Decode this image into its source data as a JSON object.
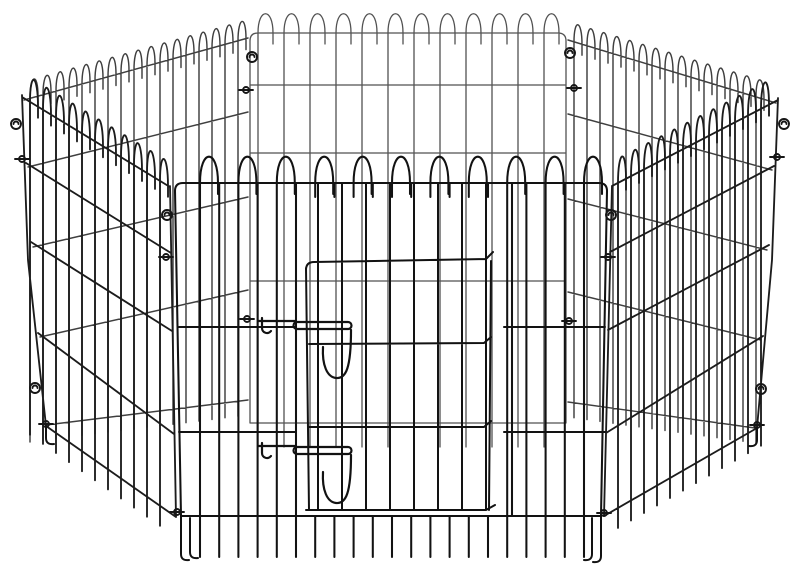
{
  "meta": {
    "alt": "Black metal wire pet exercise playpen: six hinged mesh panels arranged in a hexagon, each panel topped with rounded wire loops, with a latched wire door in the front panel, photographed on a plain white background",
    "background": "#ffffff",
    "viewBox": "0 0 800 588",
    "panel_count": 6,
    "latch_count": 2
  },
  "palette": {
    "front": "#121212",
    "frontSide": "#1c1c1c",
    "backSide": "#3f3f3f",
    "back": "#525252"
  },
  "pen": {
    "panels": [
      {
        "name": "back-panel",
        "color": "back",
        "w": 1.3,
        "rounded": true,
        "levels": [
          [
            [
              250,
              33
            ],
            [
              566,
              33
            ]
          ],
          [
            [
              250,
              85
            ],
            [
              566,
              85
            ]
          ],
          [
            [
              250,
              153
            ],
            [
              566,
              153
            ]
          ],
          [
            [
              250,
              281
            ],
            [
              566,
              281
            ]
          ],
          [
            [
              250,
              423
            ],
            [
              566,
              423
            ]
          ]
        ],
        "posts": [
          [
            [
              250,
              41
            ],
            [
              250,
              423
            ]
          ],
          [
            [
              566,
              41
            ],
            [
              566,
              423
            ]
          ]
        ],
        "verticals": {
          "x0": 258,
          "x1": 546,
          "step": 26,
          "stub": 24
        },
        "loops": {
          "w": 15,
          "apex": 19,
          "every": 1
        }
      },
      {
        "name": "back-left-panel",
        "color": "backSide",
        "w": 1.45,
        "levels": [
          [
            [
              24,
              100
            ],
            [
              248,
              38
            ]
          ],
          [
            [
              28,
              167
            ],
            [
              248,
              112
            ]
          ],
          [
            [
              33,
              247
            ],
            [
              248,
              197
            ]
          ],
          [
            [
              40,
              337
            ],
            [
              248,
              290
            ]
          ],
          [
            [
              46,
              425
            ],
            [
              248,
              400
            ]
          ]
        ],
        "posts": [],
        "verticals": {
          "x0": 30,
          "x1": 240,
          "step": 13,
          "stub": 15
        },
        "loops": {
          "w": 8,
          "apex": 18,
          "every": 1
        }
      },
      {
        "name": "back-right-panel",
        "color": "backSide",
        "w": 1.45,
        "levels": [
          [
            [
              568,
              40
            ],
            [
              776,
              103
            ]
          ],
          [
            [
              568,
              114
            ],
            [
              772,
              170
            ]
          ],
          [
            [
              568,
              199
            ],
            [
              767,
              250
            ]
          ],
          [
            [
              568,
              292
            ],
            [
              761,
              340
            ]
          ],
          [
            [
              568,
              402
            ],
            [
              755,
              428
            ]
          ]
        ],
        "posts": [],
        "verticals": {
          "x0": 574,
          "x1": 766,
          "step": 13,
          "stub": 15
        },
        "loops": {
          "w": 8,
          "apex": 18,
          "every": 1
        }
      },
      {
        "name": "front-left-panel",
        "color": "frontSide",
        "w": 1.85,
        "levels": [
          [
            [
              22,
              97
            ],
            [
              170,
              187
            ]
          ],
          [
            [
              26,
              163
            ],
            [
              171,
              253
            ]
          ],
          [
            [
              31,
              242
            ],
            [
              172,
              331
            ]
          ],
          [
            [
              38,
              333
            ],
            [
              174,
              434
            ]
          ],
          [
            [
              46,
              426
            ],
            [
              176,
              517
            ]
          ]
        ],
        "posts": [
          [
            [
              170,
              186
            ],
            [
              176,
              517
            ]
          ],
          [
            [
              22,
              95
            ],
            [
              28,
              260
            ],
            [
              46,
              426
            ]
          ]
        ],
        "verticals": {
          "x0": 30,
          "x1": 162,
          "step": 13,
          "stub": 20
        },
        "loops": {
          "w": 8,
          "apex": 24,
          "every": 1
        }
      },
      {
        "name": "front-right-panel",
        "color": "frontSide",
        "w": 1.85,
        "levels": [
          [
            [
              612,
              186
            ],
            [
              778,
              100
            ]
          ],
          [
            [
              610,
              252
            ],
            [
              774,
              166
            ]
          ],
          [
            [
              608,
              330
            ],
            [
              769,
              245
            ]
          ],
          [
            [
              606,
              433
            ],
            [
              763,
              336
            ]
          ],
          [
            [
              604,
              516
            ],
            [
              757,
              428
            ]
          ]
        ],
        "posts": [
          [
            [
              612,
              186
            ],
            [
              604,
              516
            ]
          ],
          [
            [
              778,
              98
            ],
            [
              772,
              260
            ],
            [
              757,
              428
            ]
          ]
        ],
        "verticals": {
          "x0": 618,
          "x1": 766,
          "step": 13,
          "stub": 20
        },
        "loops": {
          "w": 8,
          "apex": 24,
          "every": 1
        }
      },
      {
        "name": "front-panel",
        "color": "front",
        "w": 2.05,
        "rounded": true,
        "levels": [
          [
            [
              175,
              183
            ],
            [
              607,
              183
            ]
          ],
          [
            [
              181,
              516
            ],
            [
              601,
              516
            ]
          ]
        ],
        "posts": [
          [
            [
              175,
              191
            ],
            [
              181,
              516
            ]
          ],
          [
            [
              607,
              191
            ],
            [
              601,
              516
            ]
          ]
        ],
        "verticals": {
          "x0": 200,
          "x1": 585,
          "step": 19.2,
          "stub": 41,
          "skip": [
            300,
            500
          ]
        },
        "loops": {
          "w": 18,
          "apex": 26,
          "every": 2
        },
        "extra": [
          [
            179,
            327,
            296,
            327
          ],
          [
            504,
            327,
            605,
            327
          ],
          [
            179,
            432,
            296,
            432
          ],
          [
            504,
            432,
            605,
            432
          ],
          [
            296,
            183,
            296,
            516
          ],
          [
            512,
            183,
            512,
            516
          ]
        ]
      }
    ],
    "door": {
      "name": "front-door",
      "color": "front",
      "w": 2.0,
      "paths": [
        "M306,270 Q306,262 314,262 L486,259 L493,252",
        "M306,268 L309,510",
        "M491,261 L489,510",
        "M309,344 L484,343 L491,337",
        "M309,427 L484,427 L491,421",
        "M306,510 L486,510 L495,505"
      ],
      "verticals": {
        "x0": 318,
        "x1": 487,
        "step": 24,
        "y0": 184,
        "y1": 509
      }
    },
    "latches": [
      {
        "name": "door-latch-upper",
        "paths": [
          "M258,321 L296,321",
          "M262,318 L262,328 A5,5 0 0 0 271,331",
          "M297,322 L348,322 A3.5,3.5 0 0 1 348,329 L297,329 A3.5,3.5 0 0 1 297,322 Z",
          "M323,347 C322,365 327,377 336,378 C346,379 351,368 351,330"
        ]
      },
      {
        "name": "door-latch-lower",
        "paths": [
          "M258,446 L296,446",
          "M262,443 L262,453 A5,5 0 0 0 271,456",
          "M297,447 L348,447 A3.5,3.5 0 0 1 348,454 L297,454 A3.5,3.5 0 0 1 297,447 Z",
          "M323,472 C322,490 327,502 336,503 C346,504 351,493 351,455"
        ]
      }
    ],
    "hooks": [
      {
        "t": "s",
        "x": 16,
        "y": 124
      },
      {
        "t": "w",
        "x": 22,
        "y": 159
      },
      {
        "t": "s",
        "x": 35,
        "y": 388
      },
      {
        "t": "w",
        "x": 46,
        "y": 424
      },
      {
        "t": "s",
        "x": 167,
        "y": 215
      },
      {
        "t": "w",
        "x": 166,
        "y": 257
      },
      {
        "t": "w",
        "x": 177,
        "y": 512
      },
      {
        "t": "s",
        "x": 252,
        "y": 57
      },
      {
        "t": "w",
        "x": 246,
        "y": 90
      },
      {
        "t": "w",
        "x": 247,
        "y": 319
      },
      {
        "t": "s",
        "x": 570,
        "y": 53
      },
      {
        "t": "w",
        "x": 574,
        "y": 88
      },
      {
        "t": "w",
        "x": 569,
        "y": 321
      },
      {
        "t": "s",
        "x": 611,
        "y": 215
      },
      {
        "t": "w",
        "x": 608,
        "y": 257
      },
      {
        "t": "w",
        "x": 604,
        "y": 513
      },
      {
        "t": "s",
        "x": 784,
        "y": 124
      },
      {
        "t": "w",
        "x": 777,
        "y": 157
      },
      {
        "t": "s",
        "x": 761,
        "y": 389
      },
      {
        "t": "w",
        "x": 757,
        "y": 425
      }
    ],
    "feet": [
      {
        "x": 181,
        "y": 516,
        "len": 38,
        "dir": 1
      },
      {
        "x": 190,
        "y": 518,
        "len": 34,
        "dir": 1
      },
      {
        "x": 601,
        "y": 516,
        "len": 40,
        "dir": -1
      },
      {
        "x": 592,
        "y": 518,
        "len": 36,
        "dir": -1
      },
      {
        "x": 46,
        "y": 426,
        "len": 12,
        "dir": 1
      },
      {
        "x": 757,
        "y": 428,
        "len": 12,
        "dir": -1
      }
    ]
  }
}
